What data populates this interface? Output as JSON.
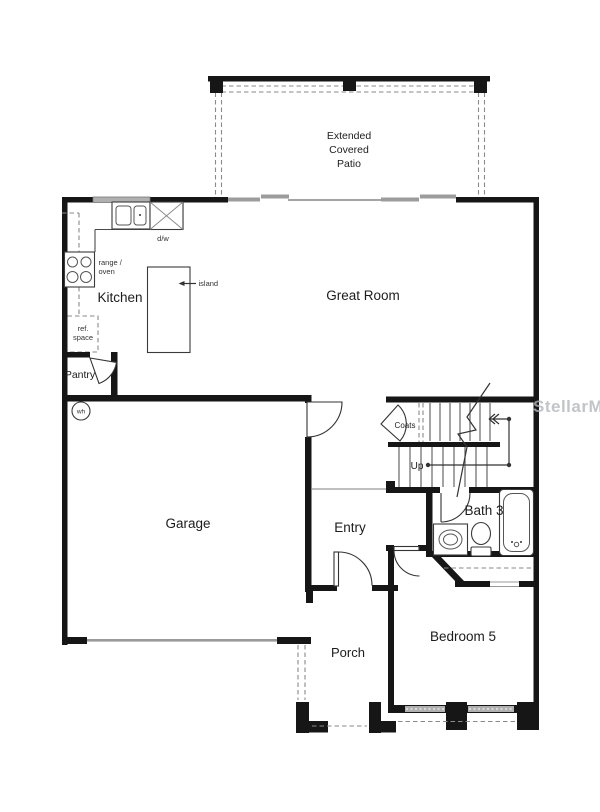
{
  "watermark": "StellarMLS",
  "rooms": {
    "patio_line1": "Extended",
    "patio_line2": "Covered",
    "patio_line3": "Patio",
    "great_room": "Great Room",
    "kitchen": "Kitchen",
    "garage": "Garage",
    "entry": "Entry",
    "pantry": "Pantry",
    "coats": "Coats",
    "up": "Up",
    "bath3": "Bath 3",
    "bedroom5": "Bedroom 5",
    "porch": "Porch"
  },
  "fixtures": {
    "dw": "d/w",
    "range_line1": "range /",
    "range_line2": "oven",
    "ref_line1": "ref.",
    "ref_line2": "space",
    "island": "island",
    "wh": "wh"
  },
  "colors": {
    "wall": "#161616",
    "gray_fill": "#a9a9a9",
    "dashed": "#8a8a8a",
    "watermark": "#b2b7bc"
  }
}
